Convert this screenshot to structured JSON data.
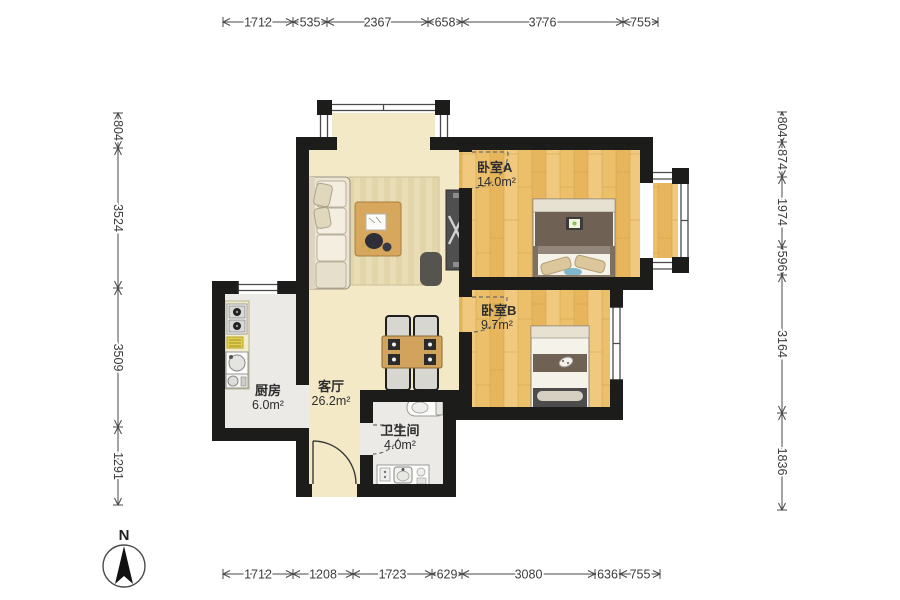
{
  "title": "apartment-floor-plan",
  "dimensions": {
    "top": [
      "1712",
      "535",
      "2367",
      "658",
      "3776",
      "755"
    ],
    "bottom": [
      "1712",
      "1208",
      "1723",
      "629",
      "3080",
      "636",
      "755"
    ],
    "left": [
      "804",
      "3524",
      "3509",
      "1291"
    ],
    "right": [
      "804",
      "874",
      "1974",
      "596",
      "3164",
      "1836"
    ]
  },
  "rooms": {
    "bedroomA": {
      "label": "卧室A",
      "area": "14.0m²"
    },
    "bedroomB": {
      "label": "卧室B",
      "area": "9.7m²"
    },
    "living": {
      "label": "客厅",
      "area": "26.2m²"
    },
    "kitchen": {
      "label": "厨房",
      "area": "6.0m²"
    },
    "bathroom": {
      "label": "卫生间",
      "area": "4.0m²"
    }
  },
  "compass": {
    "label": "N"
  },
  "colors": {
    "wall": "#1c1c1a",
    "wood_floor": "#ecc06b",
    "living_floor": "#f3e9c7",
    "tile_floor": "#eceae7",
    "dimension_text": "#3c3c3c"
  }
}
